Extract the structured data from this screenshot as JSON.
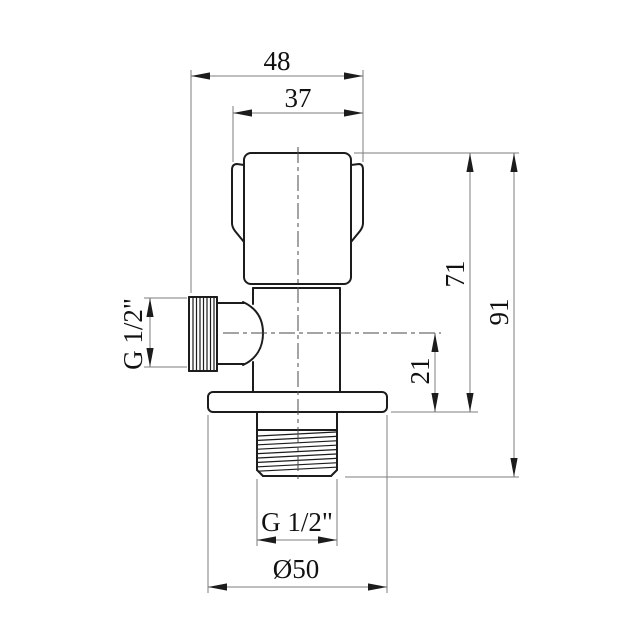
{
  "drawing": {
    "type": "technical-drawing",
    "subject": "angle-valve-front-view",
    "dimensions": {
      "top_width": "48",
      "handle_width": "37",
      "total_height": "91",
      "body_height": "71",
      "outlet_center_to_flange": "21",
      "side_thread": "G 1/2\"",
      "bottom_thread": "G 1/2\"",
      "flange_diameter": "Ø50"
    },
    "colors": {
      "background": "#ffffff",
      "part_line": "#1c1c1c",
      "centerline": "#4a4a4a",
      "dimension_line": "#7d7d7d",
      "text": "#111111"
    }
  }
}
